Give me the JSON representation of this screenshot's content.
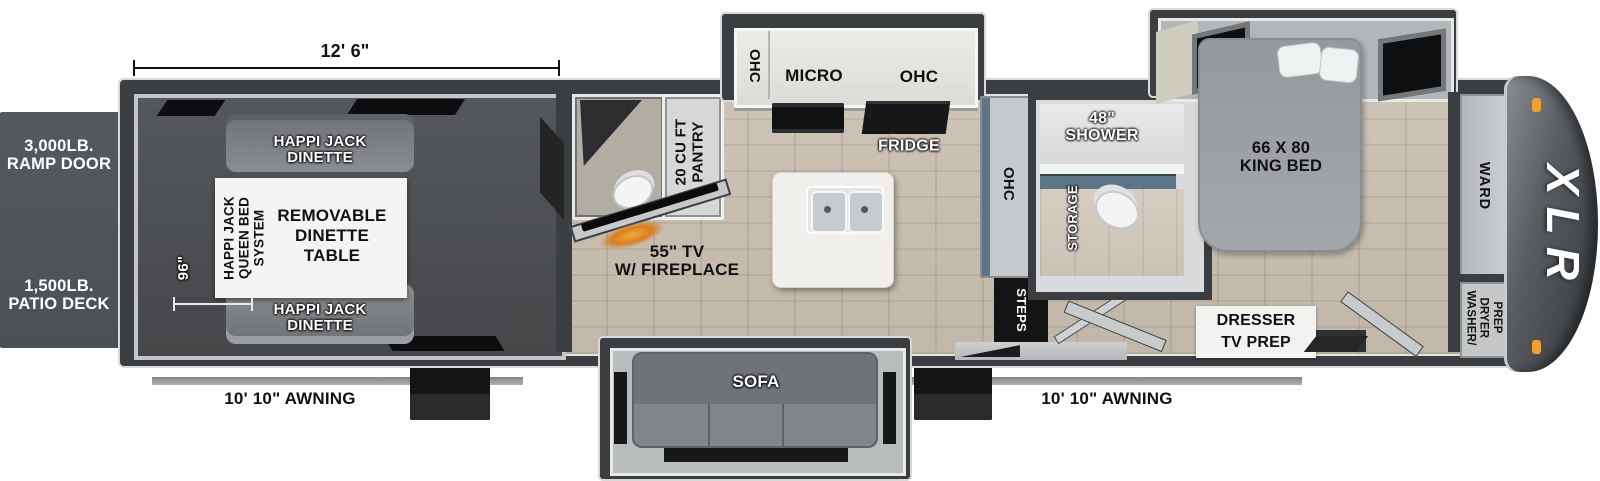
{
  "labels": {
    "dim_width": "12' 6\"",
    "dim_depth": "96\"",
    "ramp_door": {
      "line1": "3,000LB.",
      "line2": "RAMP DOOR"
    },
    "patio_deck": {
      "line1": "1,500LB.",
      "line2": "PATIO DECK"
    },
    "awning_left": "10' 10\" AWNING",
    "awning_right": "10' 10\" AWNING",
    "brand": "XLR"
  },
  "garage": {
    "dinette_top": {
      "line1": "HAPPI JACK",
      "line2": "DINETTE"
    },
    "dinette_bottom": {
      "line1": "HAPPI JACK",
      "line2": "DINETTE"
    },
    "bed_system": {
      "line1": "HAPPI JACK",
      "line2": "QUEEN BED",
      "line3": "SYSTEM"
    },
    "table": {
      "line1": "REMOVABLE",
      "line2": "DINETTE",
      "line3": "TABLE"
    }
  },
  "kitchen": {
    "ohc_left": "OHC",
    "micro": "MICRO",
    "ohc_right": "OHC",
    "fridge": "FRIDGE",
    "pantry": {
      "line1": "20 CU FT",
      "line2": "PANTRY"
    },
    "tv": {
      "line1": "55\" TV",
      "line2": "W/ FIREPLACE"
    },
    "ohc_tall": "OHC"
  },
  "living": {
    "sofa": "SOFA",
    "steps": "STEPS"
  },
  "bathroom": {
    "shower": {
      "line1": "48\"",
      "line2": "SHOWER"
    },
    "storage": "STORAGE"
  },
  "bedroom": {
    "king_bed": {
      "line1": "66 X 80",
      "line2": "KING BED"
    },
    "ward": "WARD",
    "dresser": {
      "line1": "DRESSER",
      "line2": "TV PREP"
    },
    "washer_dryer": {
      "line1": "WASHER/",
      "line2": "DRYER",
      "line3": "PREP"
    }
  },
  "colors": {
    "wall": "#3b3e41",
    "accent_orange": "#e89a2e",
    "vanity_blue": "#5e7487"
  }
}
